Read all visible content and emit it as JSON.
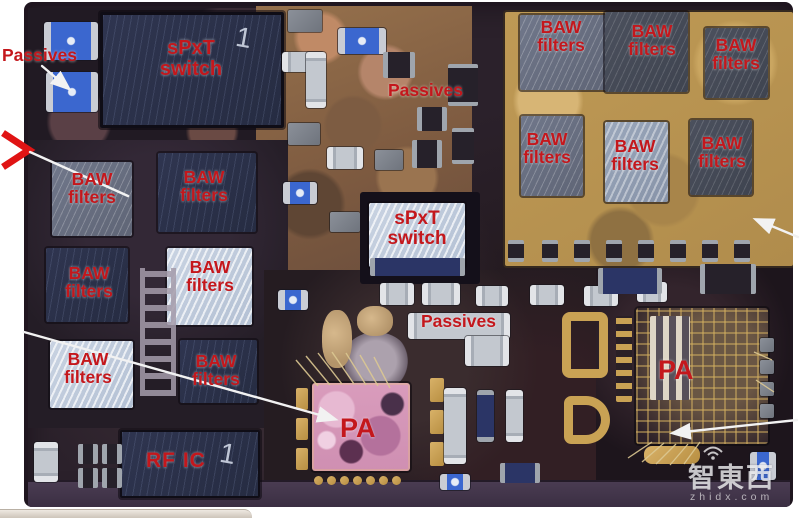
{
  "figure": {
    "annotations": {
      "passives": [
        "Passives",
        "Passives",
        "Passives"
      ],
      "spxt_switch": [
        "sPxT switch",
        "sPxT switch"
      ],
      "baw_left": [
        "BAW filters",
        "BAW filters",
        "BAW filters",
        "BAW filters",
        "BAW filters",
        "BAW filters"
      ],
      "baw_right": [
        "BAW filters",
        "BAW filters",
        "BAW filters",
        "BAW filters",
        "BAW filters",
        "BAW filters"
      ],
      "rf_ic": "RF IC",
      "pa": [
        "PA",
        "PA"
      ],
      "die_marks": [
        "1",
        "1"
      ]
    },
    "watermark": {
      "logo": "智東西",
      "site": "zhidx.com"
    },
    "colors": {
      "label_red": "#c4171c",
      "gold_region": "#bb9550",
      "die_navy": "#2d3349",
      "die_light": "#c7d1e0",
      "pa_pink": "#d79ab8",
      "gold": "#c9a254",
      "leader_white": "#f2f2f2",
      "chevron_red": "#e01414"
    }
  }
}
